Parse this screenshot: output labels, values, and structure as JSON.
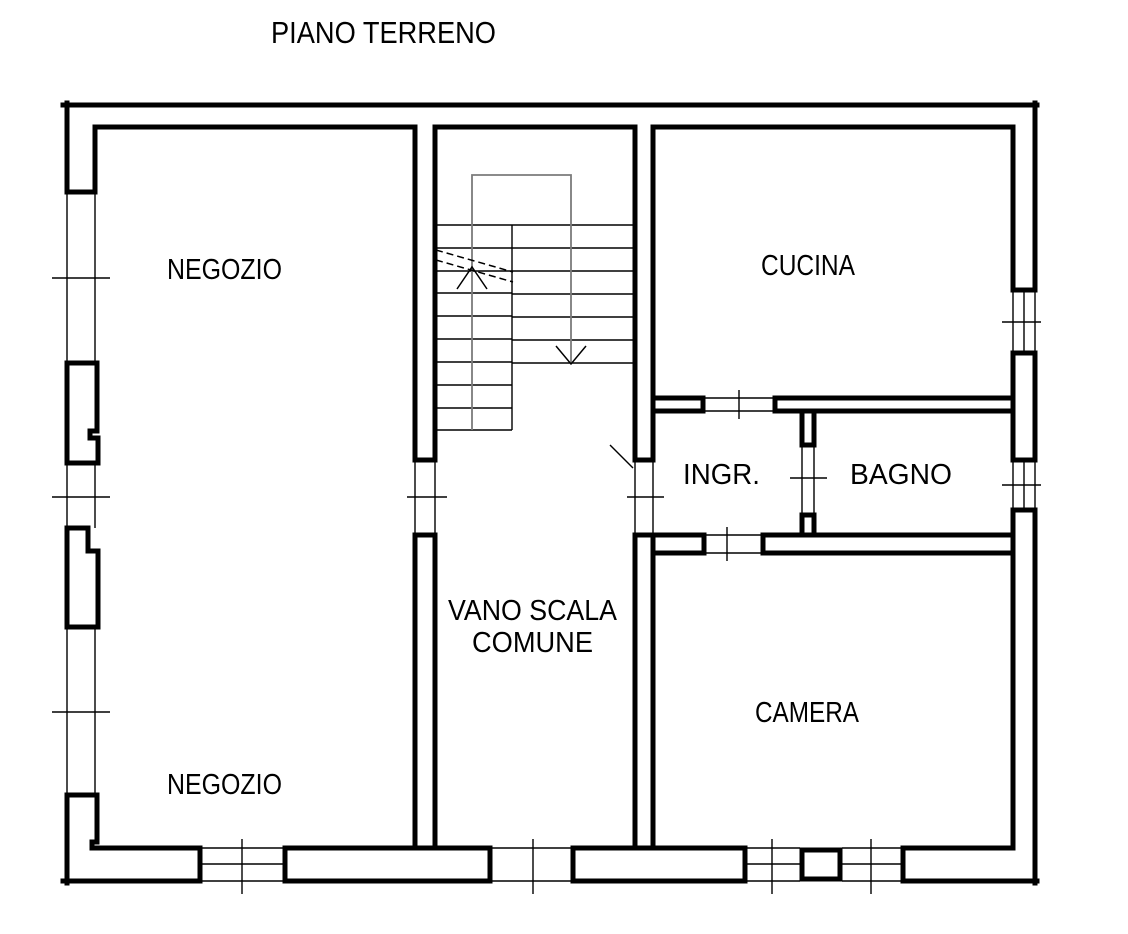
{
  "page": {
    "title": "PIANO TERRENO",
    "background_color": "#ffffff"
  },
  "floor_plan": {
    "wall_color": "#000000",
    "walkline_color": "#7b7b7b",
    "labels": {
      "negozio_top": "NEGOZIO",
      "cucina": "CUCINA",
      "ingresso": "INGR.",
      "bagno": "BAGNO",
      "vano_scala_line1": "VANO SCALA",
      "vano_scala_line2": "COMUNE",
      "camera": "CAMERA",
      "negozio_bottom": "NEGOZIO"
    },
    "staircase": {
      "up_flight_tread_lines": 10,
      "down_flight_tread_lines": 7,
      "arrows": [
        "up",
        "down"
      ]
    }
  }
}
